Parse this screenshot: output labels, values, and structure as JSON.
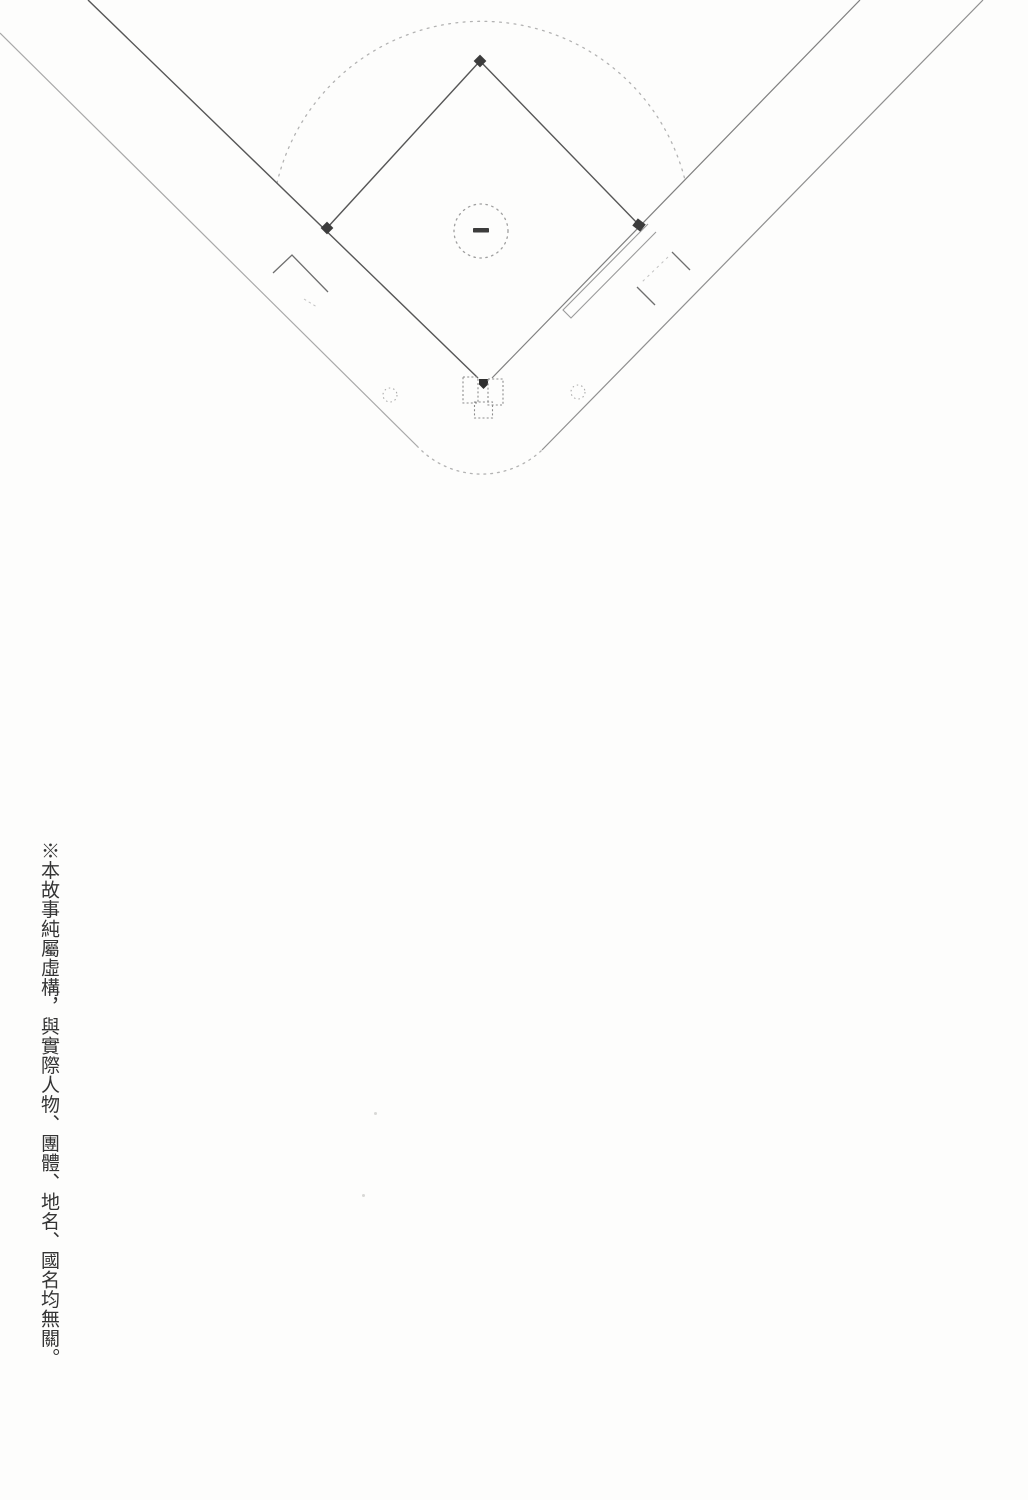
{
  "disclaimer": {
    "text": "※本故事純屬虛構，與實際人物、團體、地名、國名均無關。"
  },
  "diagram": {
    "name": "baseball-field-diagram",
    "parts": [
      "outfield-grass-arc",
      "foul-line-left",
      "foul-line-right",
      "basepath-second-to-third",
      "basepath-second-to-first",
      "boundary-line-left",
      "boundary-line-right",
      "backstop-arc",
      "pitchers-mound-circle",
      "pitchers-rubber",
      "first-base",
      "second-base",
      "third-base",
      "home-plate",
      "batters-box-left",
      "batters-box-right",
      "catchers-box",
      "on-deck-circle-left",
      "on-deck-circle-right",
      "running-lane-first-base",
      "coach-box-third-base",
      "coach-box-first-base"
    ],
    "colors": {
      "ink_dark": "#525252",
      "ink_mid": "#8f8f8f",
      "ink_light": "#b3b3b3",
      "base_fill": "#3c3c3c",
      "background": "#fdfdfc"
    }
  }
}
